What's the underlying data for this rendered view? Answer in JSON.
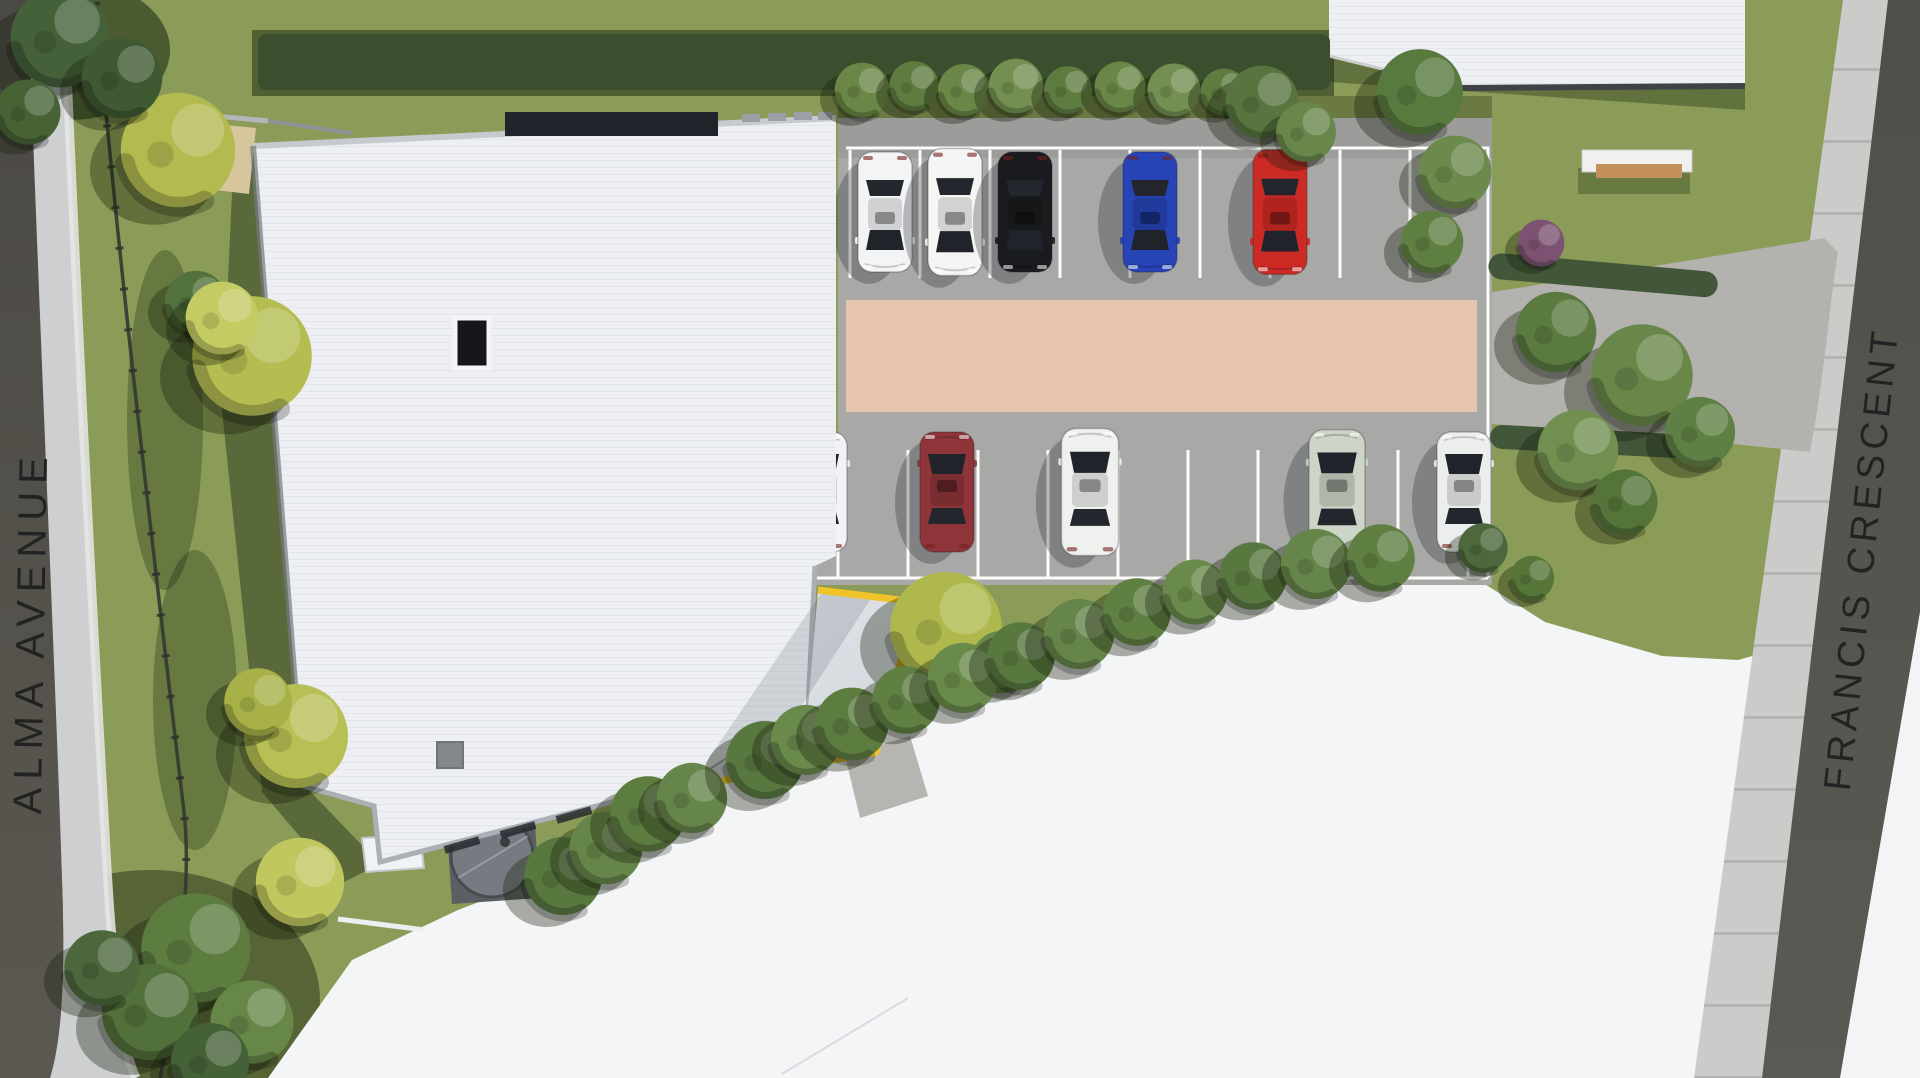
{
  "scene": {
    "description": "Aerial top-down 3D render of a site plan with building, car park and landscaping"
  },
  "streets": {
    "alma": "ALMA AVENUE",
    "francis": "FRANCIS CRESCENT"
  },
  "palette": {
    "grass": "#8a9c57",
    "asphalt": "#a8a8a6",
    "pedestrian_band": "#e5c5ad",
    "roof_white": "#edeff2",
    "canopy_trim_yellow": "#f0c428",
    "street_strip_dark": "#54524d",
    "footpath": "#cbcbc9",
    "vacant_lot_white": "#f4f5f7"
  },
  "building": {
    "roof_panel_color": "#20242a",
    "trim_color": "#f0c428"
  },
  "parking": {
    "pedestrian_band_color": "#e5c5ad",
    "top_row": {
      "stalls": 9,
      "occupied": 5,
      "cars": [
        {
          "x": 885,
          "color_name": "white",
          "hex": "#f3f4f5"
        },
        {
          "x": 955,
          "color_name": "white",
          "hex": "#f5f5f3",
          "len": 1.06
        },
        {
          "x": 1025,
          "color_name": "black",
          "hex": "#191b1e"
        },
        {
          "x": 1150,
          "color_name": "blue",
          "hex": "#2644b5"
        },
        {
          "x": 1280,
          "color_name": "red",
          "hex": "#cc2a24",
          "len": 1.04
        }
      ]
    },
    "bottom_row": {
      "stalls": 9,
      "occupied": 5,
      "cars": [
        {
          "x": 820,
          "color_name": "white",
          "hex": "#f2f3f4"
        },
        {
          "x": 947,
          "color_name": "maroon",
          "hex": "#8f353a"
        },
        {
          "x": 1090,
          "color_name": "white",
          "hex": "#eff1ef",
          "len": 1.06,
          "w": 1.06
        },
        {
          "x": 1337,
          "color_name": "sage",
          "hex": "#ccd5c8",
          "len": 1.04,
          "w": 1.04
        },
        {
          "x": 1464,
          "color_name": "silver",
          "hex": "#eceeee"
        }
      ]
    }
  }
}
